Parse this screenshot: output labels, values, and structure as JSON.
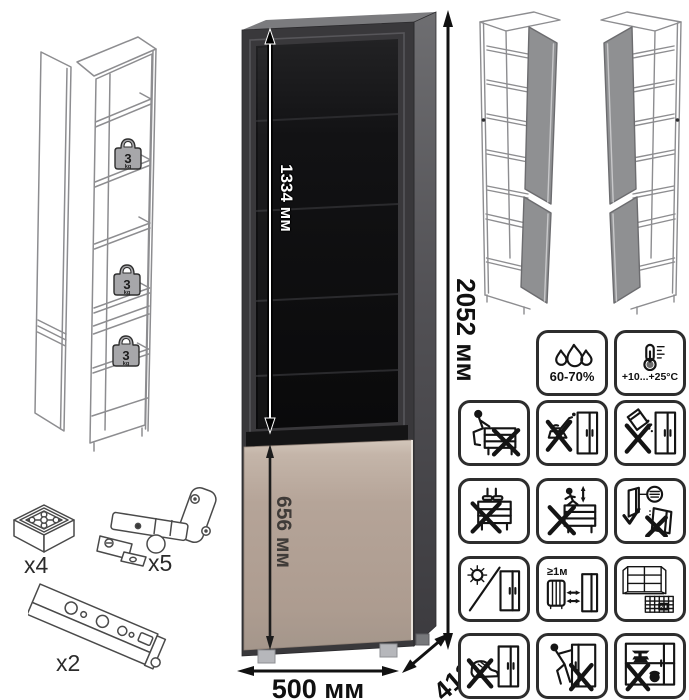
{
  "dimensions": {
    "glass_door_height": "1334 мм",
    "total_height": "2052 мм",
    "bottom_door_height": "656 мм",
    "width": "500 мм",
    "depth": "413 мм"
  },
  "shelf_load": {
    "value": "3",
    "unit": "kg"
  },
  "hardware": {
    "foot_count": "x4",
    "hinge_count": "x5",
    "rail_count": "x2"
  },
  "care": {
    "humidity": "60-70%",
    "temperature": "+10...+25°C",
    "heat_distance": "≥1м",
    "acclimatization_days": "21"
  },
  "colors": {
    "carcass_front": "#39383b",
    "glass": "#0d0d0f",
    "bottom_door": "#b5a498",
    "side_panel": "#55545a",
    "wireframe_stroke": "#8d8d90",
    "icon_stroke": "#141414"
  }
}
